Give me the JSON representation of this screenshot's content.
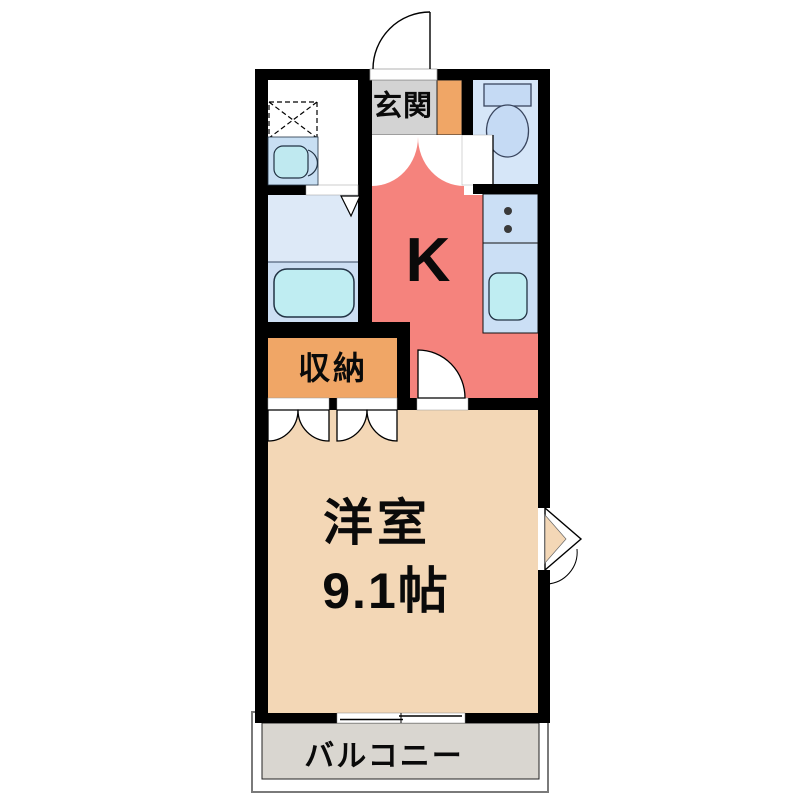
{
  "rooms": {
    "entrance": {
      "label": "玄関"
    },
    "kitchen": {
      "label": "K"
    },
    "storage": {
      "label": "収納"
    },
    "western_room": {
      "label": "洋室",
      "size": "9.1帖"
    },
    "balcony": {
      "label": "バルコニー"
    }
  },
  "colors": {
    "wall": "#000000",
    "kitchen": "#F5837D",
    "storage": "#F0A666",
    "western_room": "#F3D7B6",
    "entrance": "#D3D3D3",
    "balcony": "#D9D6D0",
    "water_blue": "#CBDFF5",
    "toilet_room": "#D6E6F8",
    "tub": "#BFEDF2"
  }
}
